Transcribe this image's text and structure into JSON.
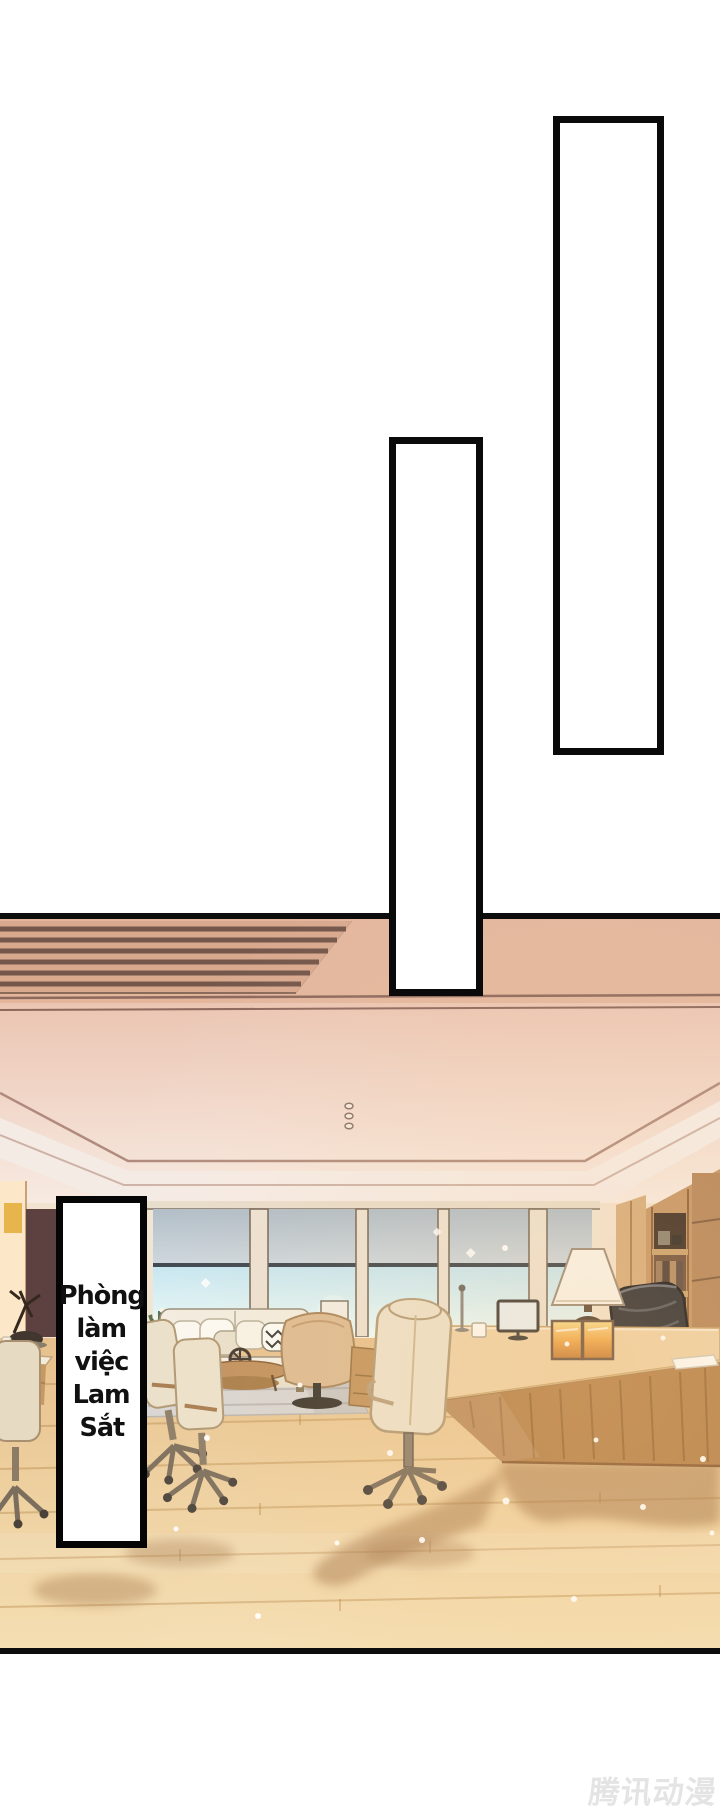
{
  "page": {
    "type": "comic-page",
    "background": "#ffffff"
  },
  "speech_boxes": [
    {
      "id": "top-right",
      "text": ""
    },
    {
      "id": "middle",
      "text": ""
    }
  ],
  "caption": {
    "text": "Phòng làm việc Lam Sắt",
    "lines": [
      "Phòng",
      "làm",
      "việc",
      "Lam",
      "Sắt"
    ]
  },
  "watermark": {
    "text": "腾讯动漫",
    "color": "#e4e4e4"
  },
  "scene": {
    "label": "executive office interior",
    "objects": [
      "ceiling-vent",
      "recessed-lights",
      "cornice-molding",
      "window-wall",
      "roller-shades",
      "sideboard-candles",
      "branch-sculpture",
      "sofa",
      "throw-pillows",
      "plant",
      "drum-lamp",
      "coffee-table",
      "area-rug",
      "swivel-armchair",
      "office-chairs",
      "guest-chair",
      "executive-desk",
      "desk-lamp",
      "monitor",
      "photo-frames",
      "papers",
      "executive-chair",
      "bookshelf",
      "wood-floor",
      "cast-shadows",
      "light-sparkles"
    ]
  },
  "colors": {
    "panel_border": "#0a0a0a",
    "ceiling_strip": "#e3b69c",
    "ceiling_light": "#f6e9e1",
    "window_shade": "#b9c4ce",
    "window_glass": "#cfeaf4",
    "desk_wood": "#b5824c",
    "floor_wood": "#eecd9e",
    "sofa": "#f3eee3",
    "executive_chair": "#2c2d33"
  }
}
